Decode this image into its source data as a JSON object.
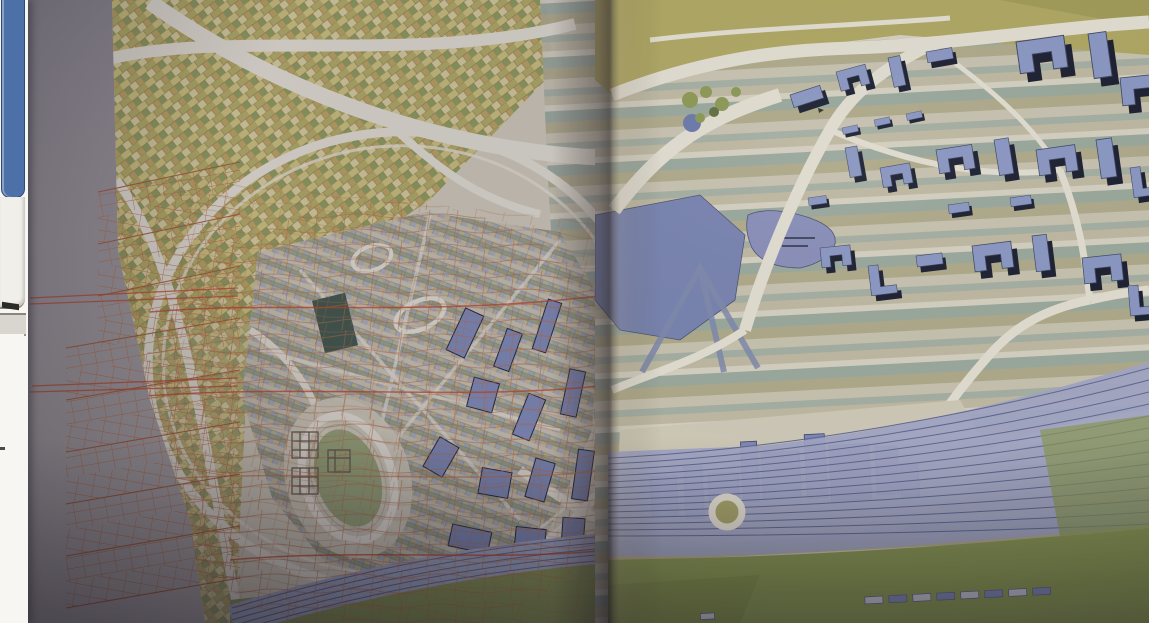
{
  "photo": {
    "subject": "Photograph of an open book spread showing a large coloured urban masterplan map drawing across both pages",
    "left_page": {
      "features": [
        "orange pleated wireframe mesh folded over the page margin",
        "diagonal patchwork of yellow and green farm plots",
        "white curving highways",
        "oval ring road enclosing a dense striped city grid",
        "athletics stadium with oval track",
        "scattered dark blue slab buildings",
        "curving striped railway band with green verge",
        "wavy orange projection grid over the plan"
      ]
    },
    "right_page": {
      "features": [
        "banded striped farmland",
        "two blue lakes",
        "district of blue axonometric buildings with black cast shadows",
        "olive highway band along the top",
        "fanning railway yard tracks",
        "roundabout",
        "flat blue industrial buildings",
        "green riverside strip with small depot sheds"
      ]
    },
    "gutter": "dark shadow fold between the two pages"
  },
  "desktop_strip": {
    "description": "sliver of desktop windows visible at the left screen edge",
    "elements": [
      "blue-window-border",
      "white-panel",
      "stacked-sheets-strip",
      "lower-white-panel"
    ]
  },
  "palette": {
    "desktop_window_blue": "#4e70a8",
    "desktop_window_border": "#2c4a7c",
    "desktop_panel": "#f1efe9",
    "desktop_gray_strip": "#d9d6d0",
    "desktop_white": "#f7f6f3",
    "page_gray_top": "#8e8990",
    "page_gray_bottom": "#b3acab",
    "paper_cream": "#d6cfbc",
    "patch_base": "#c3b771",
    "patch_gold": "#d2c47c",
    "patch_olive": "#b5ad62",
    "patch_green": "#8f9c5a",
    "patch_pale": "#dbd19c",
    "patch_tan": "#c0a45e",
    "stripe_a": "#ccc6b2",
    "stripe_b": "#a7b2a4",
    "stripe_c": "#c3bda4",
    "stripe_d": "#dad5c4",
    "stripe_e": "#9cab9e",
    "stripe_f": "#b3ad8b",
    "city_a": "#c8c2b0",
    "city_b": "#9aa6ae",
    "city_c": "#b7b08e",
    "city_d": "#8e9a7e",
    "city_e": "#c2b694",
    "city_f": "#a4aab8",
    "road_white": "#e8e3d5",
    "olive_band": "#b2a960",
    "grass": "#8c9a52",
    "grass_dark": "#7e8c48",
    "infield_green": "#9aa878",
    "lake_a": "#7884b2",
    "lake_b": "#8a90bd",
    "building_blue": "#8b99c6",
    "building_shadow": "#161b2c",
    "slab_blue": "#7d89b8",
    "slab_edge": "#1c2133",
    "flat_blue": "#7f88ba",
    "flat_blue_dark": "#6a73a8",
    "rail_base": "#a3a8c6",
    "rail_line": "#5f6791",
    "mesh_orange": "#bb6a3e",
    "mesh_fold": "#a8542e",
    "mesh_red": "#c23d1d",
    "dark_green_slab": "#3d5345",
    "gutter_shadow": "#2e2620"
  }
}
